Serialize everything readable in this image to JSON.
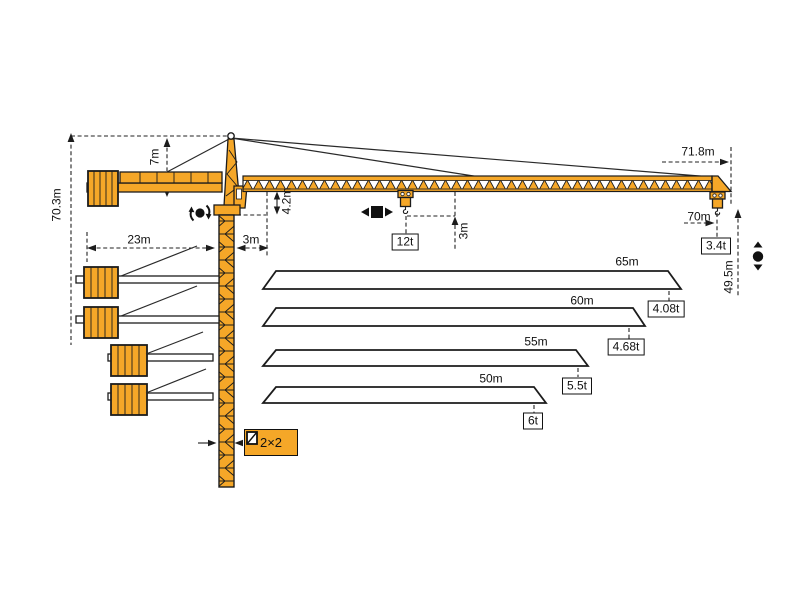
{
  "colors": {
    "crane": "#F5A728",
    "outline": "#1C1C1C"
  },
  "dims": {
    "total_height": "70.3m",
    "tower_above_jib": "7m",
    "counterjib_radius": "23m",
    "slew_offset": "3m",
    "jib_depth": "4.2m",
    "hook_clearance": "3m",
    "max_radius": "71.8m",
    "hook_radius": "70m",
    "hook_height": "49.5m"
  },
  "loads": {
    "max_capacity": "12t",
    "tip_capacity": "3.4t"
  },
  "mast": {
    "section": "2×2"
  },
  "jib_variants": [
    {
      "length": "65m",
      "tip_load": "4.08t"
    },
    {
      "length": "60m",
      "tip_load": "4.68t"
    },
    {
      "length": "55m",
      "tip_load": "5.5t"
    },
    {
      "length": "50m",
      "tip_load": "6t"
    }
  ]
}
